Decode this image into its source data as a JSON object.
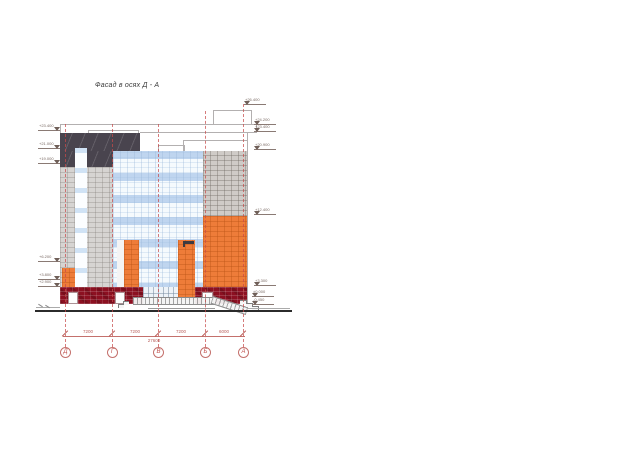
{
  "title": "Фасад в осях Д - А",
  "axes": {
    "labels": [
      "Д",
      "Г",
      "В",
      "Б",
      "А"
    ]
  },
  "dimensions": {
    "segments": [
      "7200",
      "7200",
      "7200",
      "6000"
    ],
    "overall": "27600"
  },
  "elevations": {
    "left": [
      "+23.400",
      "+21.000",
      "+19.000",
      "+6.200",
      "+3.800",
      "+2.900"
    ],
    "right": [
      "+26.400",
      "+24.200",
      "+23.400",
      "+20.900",
      "+12.400",
      "+3.300",
      "±0.000",
      "-0.450"
    ]
  },
  "colors": {
    "annotation_red": "#c0504d",
    "dark_parapet": "#49444e",
    "masonry_gray": "#d6d4d2",
    "glass_blue": "#cfe0f2",
    "facade_orange": "#ee7c39",
    "facade_maroon": "#8c1021"
  }
}
